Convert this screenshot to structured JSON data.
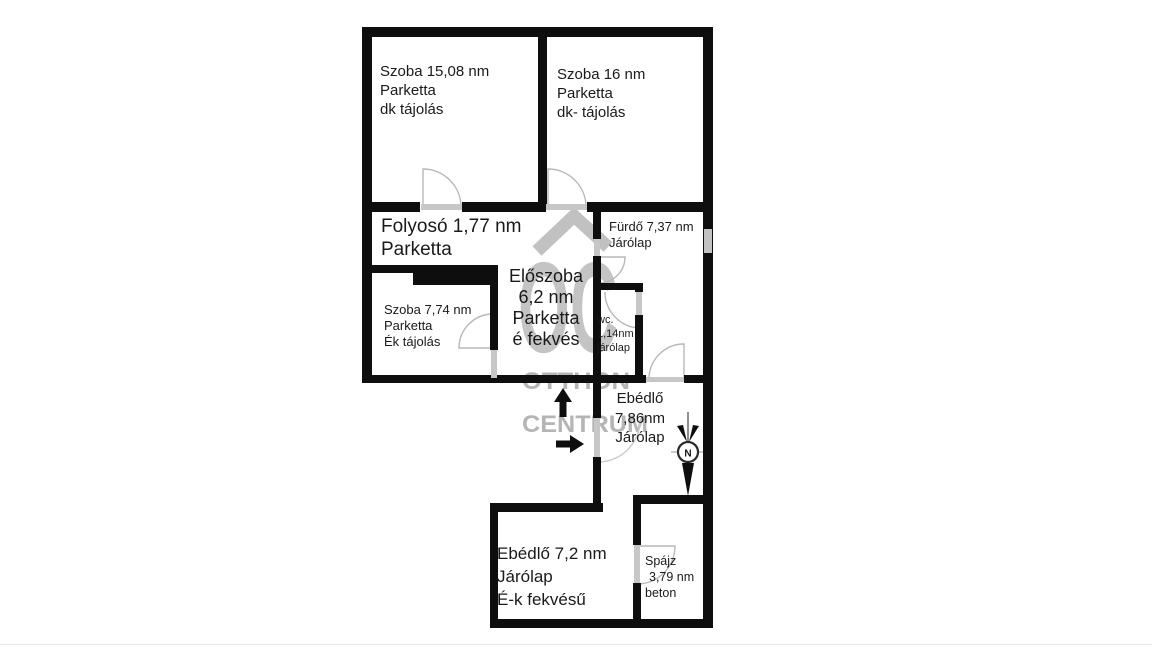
{
  "watermark": {
    "logo": "OC",
    "line1": "OTTHON",
    "line2": "CENTRUM"
  },
  "compass": {
    "north": "N"
  },
  "colors": {
    "wall": "#0e0e0e",
    "watermark_grey": "#b3b3b3",
    "door_arc_grey": "#b8b8b8"
  },
  "rooms": {
    "szoba1": {
      "line1": "Szoba 15,08 nm",
      "line2": "Parketta",
      "line3": "dk tájolás"
    },
    "szoba2": {
      "line1": "Szoba 16 nm",
      "line2": "Parketta",
      "line3": "dk- tájolás"
    },
    "folyoso": {
      "line1": "Folyosó 1,77 nm",
      "line2": "Parketta"
    },
    "eloszoba": {
      "line1": "Előszoba",
      "line2": "6,2 nm",
      "line3": "Parketta",
      "line4": "é fekvés"
    },
    "szoba3": {
      "line1": "Szoba 7,74 nm",
      "line2": "Parketta",
      "line3": "Ék tájolás"
    },
    "furdo": {
      "line1": "Fürdő 7,37 nm",
      "line2": "Járólap"
    },
    "wc": {
      "line1": "wc.",
      "line2": "1,14nm",
      "line3": "járólap"
    },
    "ebedlo1": {
      "line1": "Ebédlő",
      "line2": "7,86nm",
      "line3": "Járólap"
    },
    "ebedlo2": {
      "line1": "Ebédlő 7,2 nm",
      "line2": "Járólap",
      "line3": "É-k fekvésű"
    },
    "spajz": {
      "line1": "Spájz",
      "line2": "3,79 nm",
      "line3": "beton"
    }
  }
}
